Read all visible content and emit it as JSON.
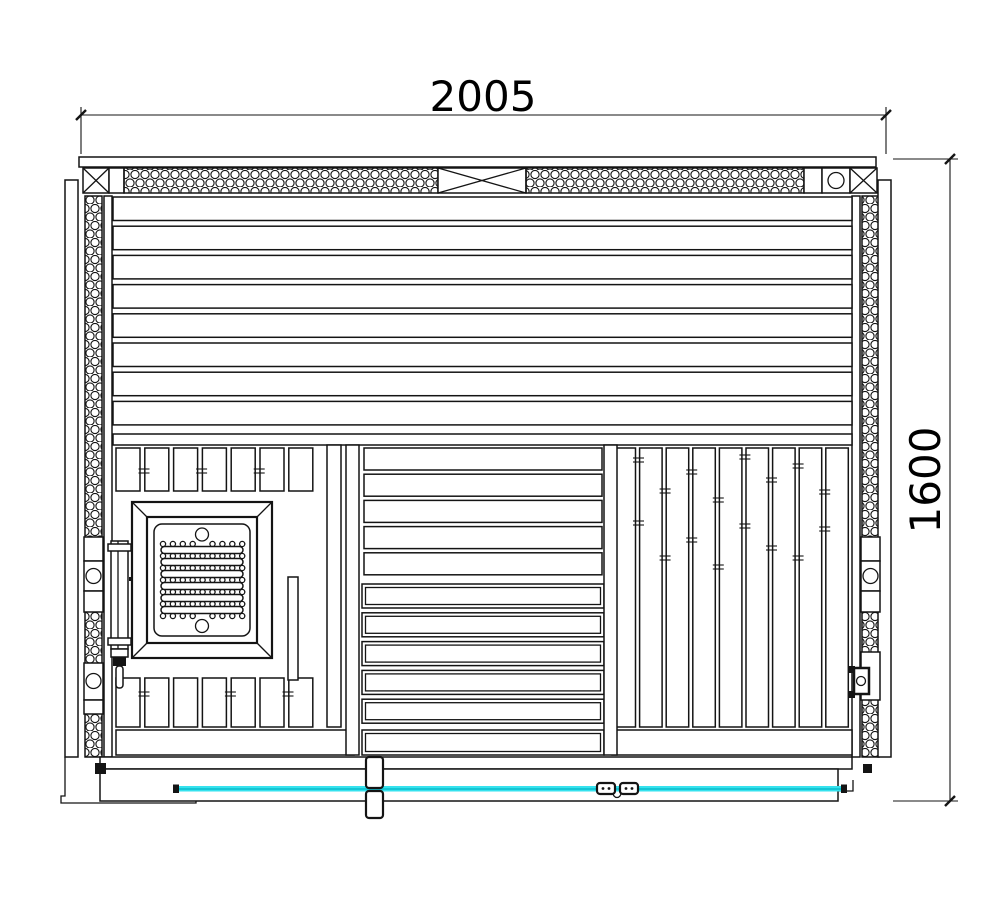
{
  "drawing": {
    "dimensions": {
      "width": "2005",
      "height": "1600"
    },
    "colors": {
      "line": "#141414",
      "highlight_line": "#35e2ee",
      "highlight_core": "#00b4c4"
    }
  }
}
